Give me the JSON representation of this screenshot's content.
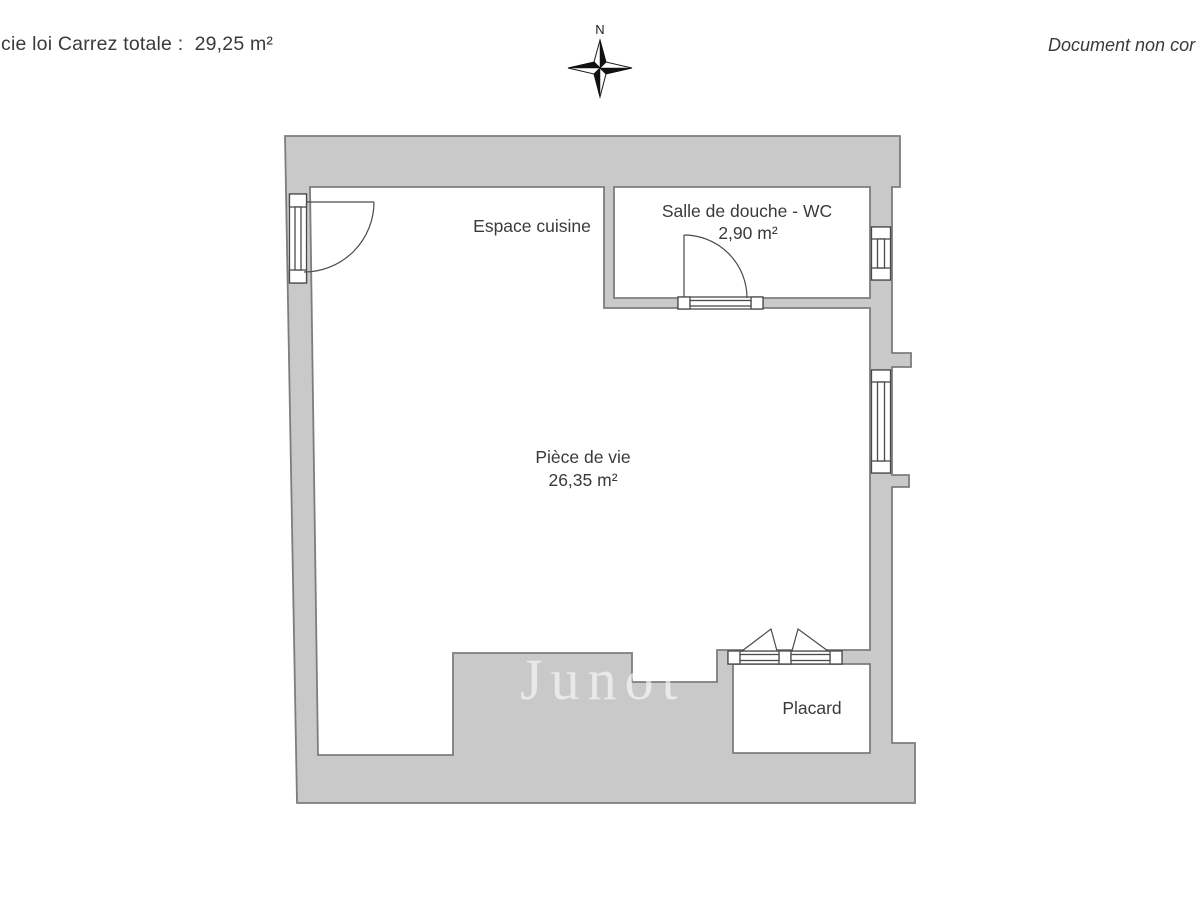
{
  "header": {
    "left_text": "cie loi Carrez totale :  29,25 m²",
    "right_text": "Document non cor"
  },
  "compass": {
    "north_label": "N"
  },
  "rooms": {
    "cuisine": {
      "name": "Espace cuisine"
    },
    "douche": {
      "name": "Salle de douche - WC",
      "area": "2,90 m²"
    },
    "vie": {
      "name": "Pièce de vie",
      "area": "26,35 m²"
    },
    "placard": {
      "name": "Placard"
    }
  },
  "watermark": {
    "text": "Junot"
  },
  "colors": {
    "wall_fill": "#c9c9c9",
    "wall_outline": "#7d7d7d",
    "symbol_line": "#4a4a4a",
    "label_text": "#3a3a3a",
    "watermark_text": "rgba(255,255,255,0.6)"
  }
}
